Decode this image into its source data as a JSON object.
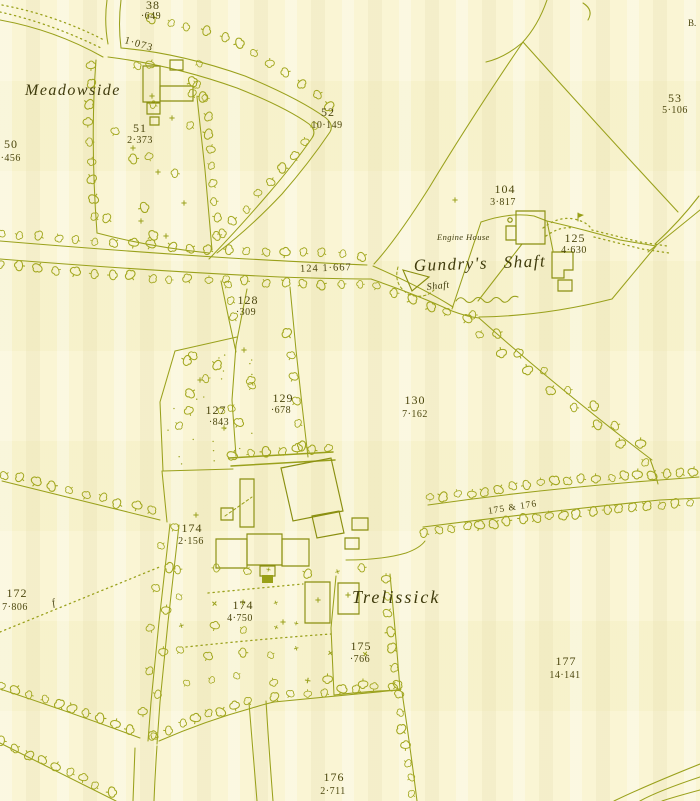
{
  "map": {
    "place_names": {
      "meadowside": "Meadowside",
      "trelissick": "Trelissick",
      "gundrys_shaft": "Gundry's Shaft",
      "shaft_small": "Shaft",
      "engine_house": "Engine House",
      "corner_note": "B."
    },
    "parcels": [
      {
        "number": "38",
        "acreage": "·649"
      },
      {
        "number": "50",
        "acreage": "2·456"
      },
      {
        "number": "51",
        "acreage": "2·373"
      },
      {
        "number": "52",
        "acreage": "10·149"
      },
      {
        "number": "53",
        "acreage": "5·106"
      },
      {
        "number": "104",
        "acreage": "3·817"
      },
      {
        "number": "125",
        "acreage": "4·630"
      },
      {
        "number": "127",
        "acreage": "·843"
      },
      {
        "number": "128",
        "acreage": "·309"
      },
      {
        "number": "129",
        "acreage": "·678"
      },
      {
        "number": "130",
        "acreage": "7·162"
      },
      {
        "number": "172",
        "acreage": "7·806"
      },
      {
        "number": "174",
        "acreage": "2·156"
      },
      {
        "number": "174",
        "acreage": "4·750"
      },
      {
        "number": "175",
        "acreage": "·766"
      },
      {
        "number": "176",
        "acreage": "2·711"
      },
      {
        "number": "177",
        "acreage": "14·141"
      }
    ],
    "road_labels": [
      {
        "text": "1·073"
      },
      {
        "text": "124   1·667"
      },
      {
        "text": "175 & 176"
      }
    ],
    "colors": {
      "paper": "#f9f4cf",
      "ink": "#9aa11c",
      "text": "#4c470e"
    }
  }
}
